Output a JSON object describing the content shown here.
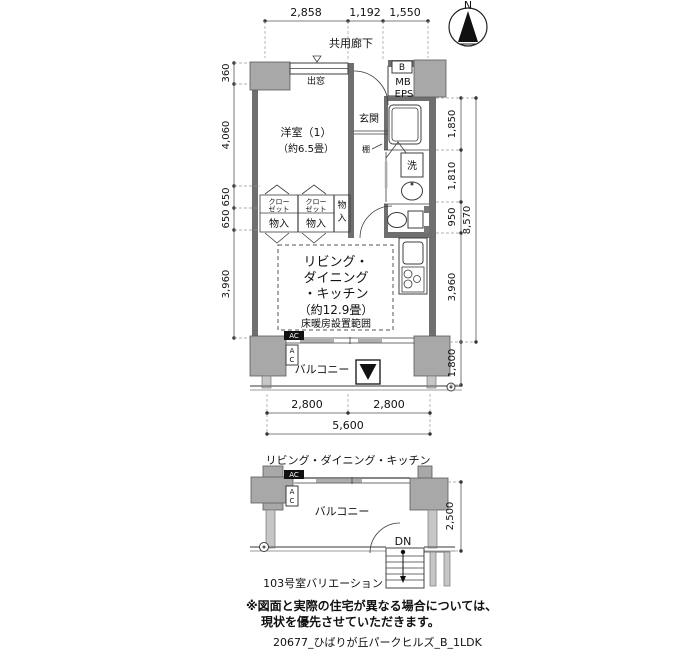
{
  "colors": {
    "wall": "#6f6f6f",
    "pillar": "#a8a8a8",
    "accent": "#111111",
    "dim_line": "#555555"
  },
  "compass": {
    "n": "N"
  },
  "dims": {
    "top": [
      "2,858",
      "1,192",
      "1,550"
    ],
    "left": [
      "360",
      "4,060",
      "650",
      "650",
      "3,960"
    ],
    "right": [
      "1,850",
      "1,810",
      "950",
      "3,960"
    ],
    "right_total": "8,570",
    "right_balcony": "1,800",
    "bottom": [
      "2,800",
      "2,800"
    ],
    "bottom_total": "5,600",
    "variation_right": "2,500"
  },
  "labels": {
    "corridor": "共用廊下",
    "bay_window": "出窓",
    "meter_b": "B",
    "meter_mb": "MB",
    "meter_eps": "EPS",
    "entrance": "玄関",
    "room1_name": "洋室（1）",
    "room1_size": "（約6.5畳）",
    "shelf": "棚",
    "washer": "洗",
    "closet_l1": "クロー",
    "closet_l2": "ゼット",
    "storage": "物入",
    "storage_v1": "物",
    "storage_v2": "入",
    "ldk_l1": "リビング・",
    "ldk_l2": "ダイニング",
    "ldk_l3": "・キッチン",
    "ldk_l4": "（約12.9畳）",
    "floor_heating": "床暖房設置範囲",
    "balcony": "バルコニー",
    "ac": "AC",
    "ac_a": "A",
    "ac_c": "C"
  },
  "variation": {
    "ldk": "リビング・ダイニング・キッチン",
    "balcony": "バルコニー",
    "dn": "DN",
    "ac": "AC",
    "ac_a": "A",
    "ac_c": "C",
    "caption": "103号室バリエーション"
  },
  "notes": {
    "line1": "※図面と実際の住宅が異なる場合については、",
    "line2": "現状を優先させていただきます。"
  },
  "footer": "20677_ひばりが丘パークヒルズ_B_1LDK"
}
